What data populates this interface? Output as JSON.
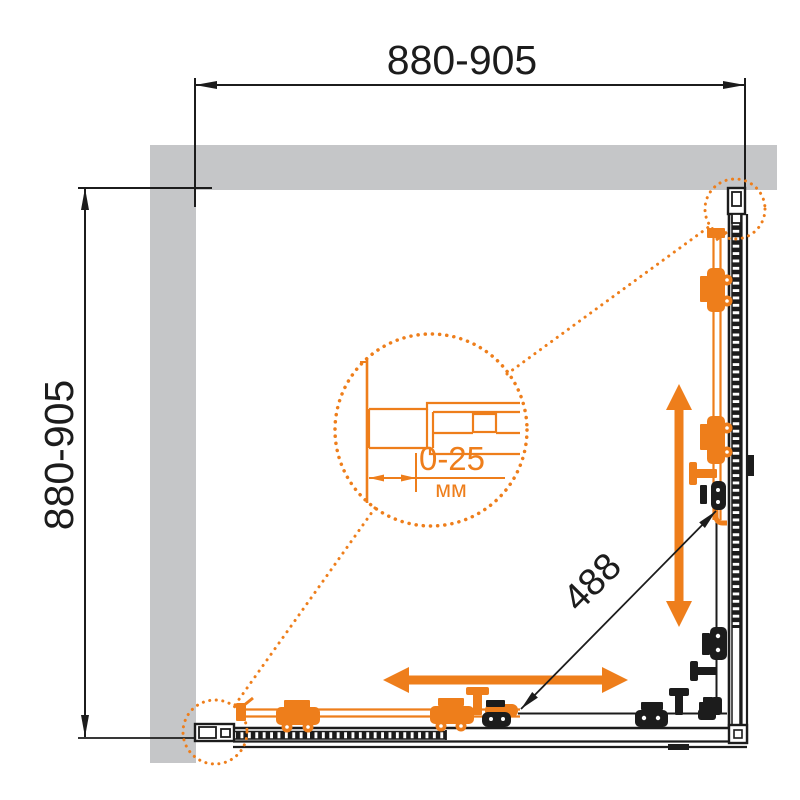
{
  "meta": {
    "description": "Top-view installation diagram of a square corner shower enclosure with two sliding doors",
    "drawing_type": "dimensional plan"
  },
  "colors": {
    "accent_orange": "#EE7E1B",
    "line_black": "#1C1C1C",
    "wall_gray": "#C5C6C8",
    "background": "#FFFFFF"
  },
  "dimensions": {
    "width_range": "880-905",
    "depth_range": "880-905",
    "diagonal_opening": "488",
    "adjustment_range": "0-25",
    "adjustment_unit": "мм"
  }
}
